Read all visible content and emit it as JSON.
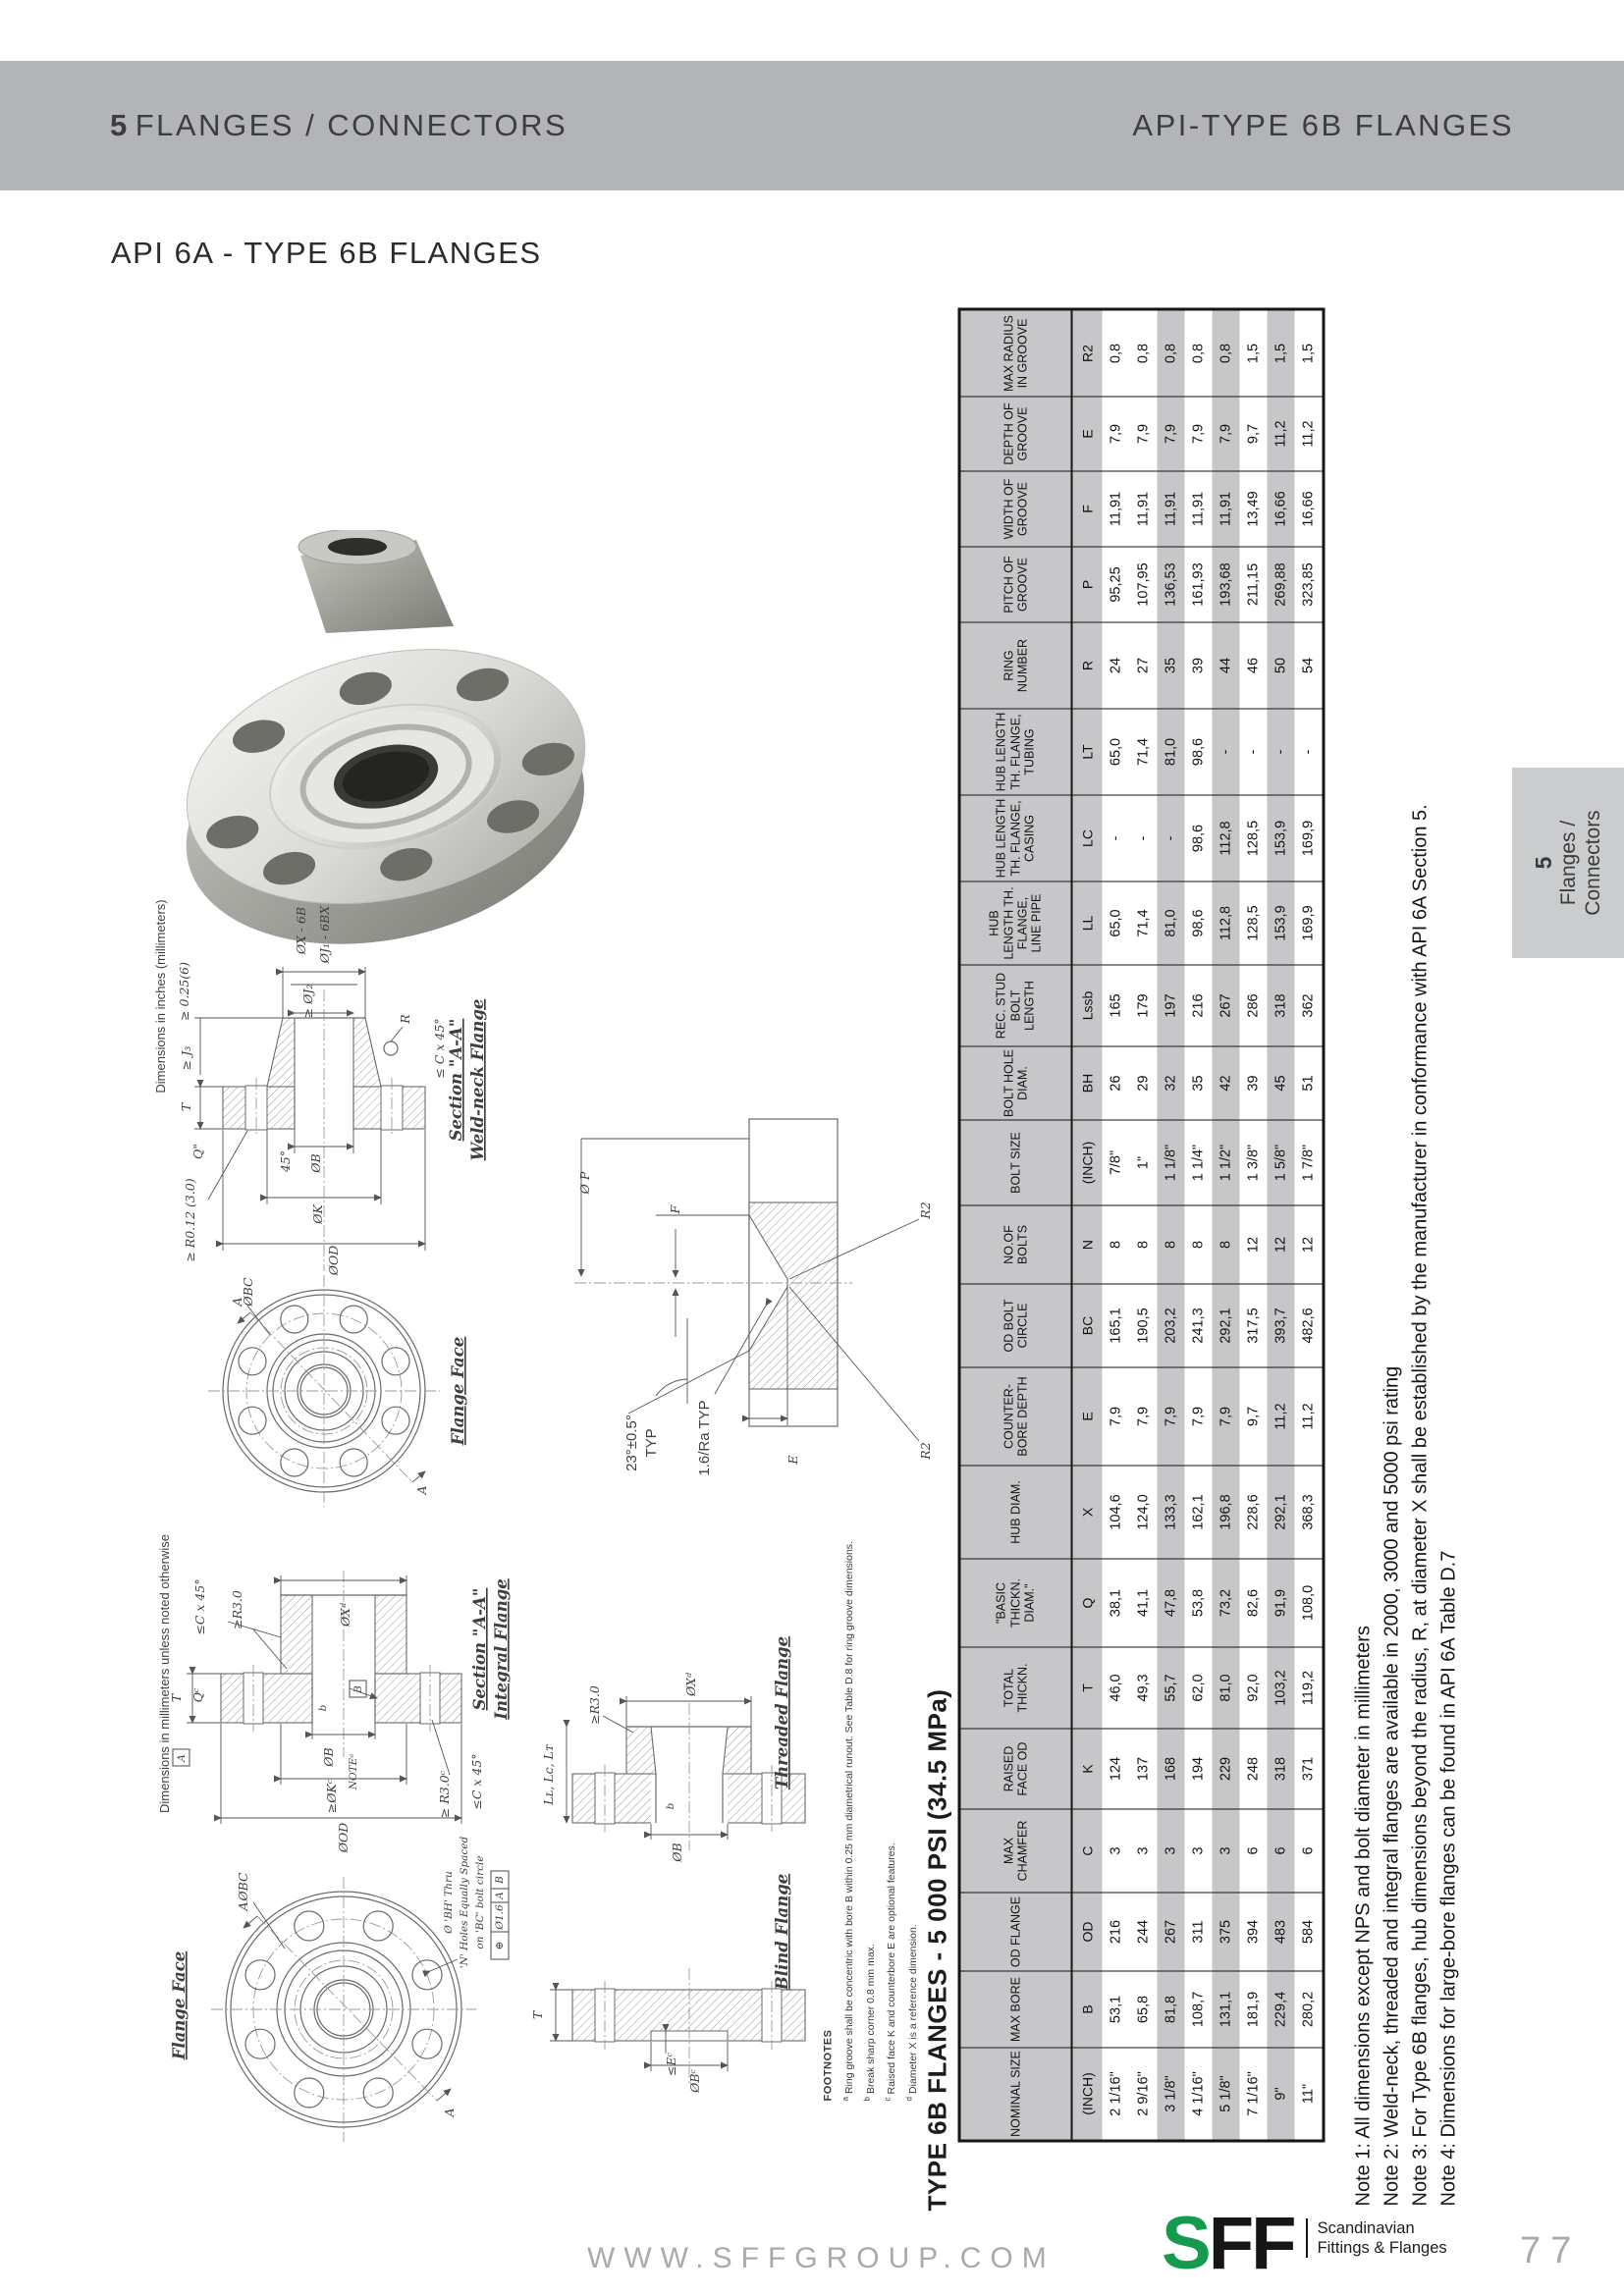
{
  "page": {
    "header": {
      "left_number": "5",
      "left_title": "FLANGES / CONNECTORS",
      "right_title": "API-TYPE 6B FLANGES"
    },
    "title": "API 6A - TYPE 6B FLANGES",
    "side_tab": {
      "number": "5",
      "line1": "Flanges /",
      "line2": "Connectors"
    },
    "footer": {
      "website": "WWW.SFFGROUP.COM",
      "logo_s": "S",
      "logo_ff": "FF",
      "logo_sub1": "Scandinavian",
      "logo_sub2": "Fittings & Flanges",
      "page_number": "77"
    },
    "colors": {
      "header_bar": "#b3b4b6",
      "table_gray": "#c7c7c9",
      "tab_gray": "#cbcccd",
      "logo_green": "#169a4f",
      "muted_gray": "#a7abae"
    }
  },
  "table": {
    "title": "TYPE 6B FLANGES - 5 000 PSI (34.5 MPa)",
    "columns": [
      {
        "label": "NOMINAL SIZE",
        "symbol": "(INCH)",
        "values": [
          "2 1/16\"",
          "2 9/16\"",
          "3 1/8\"",
          "4 1/16\"",
          "5 1/8\"",
          "7 1/16\"",
          "9\"",
          "11\""
        ]
      },
      {
        "label": "MAX BORE",
        "symbol": "B",
        "values": [
          "53,1",
          "65,8",
          "81,8",
          "108,7",
          "131,1",
          "181,9",
          "229,4",
          "280,2"
        ]
      },
      {
        "label": "OD FLANGE",
        "symbol": "OD",
        "values": [
          "216",
          "244",
          "267",
          "311",
          "375",
          "394",
          "483",
          "584"
        ]
      },
      {
        "label": "MAX CHAMFER",
        "symbol": "C",
        "values": [
          "3",
          "3",
          "3",
          "3",
          "3",
          "6",
          "6",
          "6"
        ]
      },
      {
        "label": "RAISED FACE OD",
        "symbol": "K",
        "values": [
          "124",
          "137",
          "168",
          "194",
          "229",
          "248",
          "318",
          "371"
        ]
      },
      {
        "label": "TOTAL THICKN.",
        "symbol": "T",
        "values": [
          "46,0",
          "49,3",
          "55,7",
          "62,0",
          "81,0",
          "92,0",
          "103,2",
          "119,2"
        ]
      },
      {
        "label": "\"BASIC THICKN. DIAM.\"",
        "symbol": "Q",
        "values": [
          "38,1",
          "41,1",
          "47,8",
          "53,8",
          "73,2",
          "82,6",
          "91,9",
          "108,0"
        ]
      },
      {
        "label": "HUB DIAM.",
        "symbol": "X",
        "values": [
          "104,6",
          "124,0",
          "133,3",
          "162,1",
          "196,8",
          "228,6",
          "292,1",
          "368,3"
        ]
      },
      {
        "label": "COUNTER- BORE DEPTH",
        "symbol": "E",
        "values": [
          "7,9",
          "7,9",
          "7,9",
          "7,9",
          "7,9",
          "9,7",
          "11,2",
          "11,2"
        ]
      },
      {
        "label": "OD BOLT CIRCLE",
        "symbol": "BC",
        "values": [
          "165,1",
          "190,5",
          "203,2",
          "241,3",
          "292,1",
          "317,5",
          "393,7",
          "482,6"
        ]
      },
      {
        "label": "NO.OF BOLTS",
        "symbol": "N",
        "values": [
          "8",
          "8",
          "8",
          "8",
          "8",
          "12",
          "12",
          "12"
        ]
      },
      {
        "label": "BOLT SIZE",
        "symbol": "(INCH)",
        "values": [
          "7/8\"",
          "1\"",
          "1 1/8\"",
          "1 1/4\"",
          "1 1/2\"",
          "1 3/8\"",
          "1 5/8\"",
          "1 7/8\""
        ]
      },
      {
        "label": "BOLT HOLE DIAM.",
        "symbol": "BH",
        "values": [
          "26",
          "29",
          "32",
          "35",
          "42",
          "39",
          "45",
          "51"
        ]
      },
      {
        "label": "REC. STUD BOLT LENGTH",
        "symbol": "Lssb",
        "values": [
          "165",
          "179",
          "197",
          "216",
          "267",
          "286",
          "318",
          "362"
        ]
      },
      {
        "label": "HUB LENGTH TH. FLANGE, LINE PIPE",
        "symbol": "LL",
        "values": [
          "65,0",
          "71,4",
          "81,0",
          "98,6",
          "112,8",
          "128,5",
          "153,9",
          "169,9"
        ]
      },
      {
        "label": "HUB LENGTH TH. FLANGE, CASING",
        "symbol": "LC",
        "values": [
          "-",
          "-",
          "-",
          "98,6",
          "112,8",
          "128,5",
          "153,9",
          "169,9"
        ]
      },
      {
        "label": "HUB LENGTH TH. FLANGE, TUBING",
        "symbol": "LT",
        "values": [
          "65,0",
          "71,4",
          "81,0",
          "98,6",
          "-",
          "-",
          "-",
          "-"
        ]
      },
      {
        "label": "RING NUMBER",
        "symbol": "R",
        "values": [
          "24",
          "27",
          "35",
          "39",
          "44",
          "46",
          "50",
          "54"
        ]
      },
      {
        "label": "PITCH OF GROOVE",
        "symbol": "P",
        "values": [
          "95,25",
          "107,95",
          "136,53",
          "161,93",
          "193,68",
          "211,15",
          "269,88",
          "323,85"
        ]
      },
      {
        "label": "WIDTH OF GROOVE",
        "symbol": "F",
        "values": [
          "11,91",
          "11,91",
          "11,91",
          "11,91",
          "11,91",
          "13,49",
          "16,66",
          "16,66"
        ]
      },
      {
        "label": "DEPTH OF GROOVE",
        "symbol": "E",
        "values": [
          "7,9",
          "7,9",
          "7,9",
          "7,9",
          "7,9",
          "9,7",
          "11,2",
          "11,2"
        ]
      },
      {
        "label": "MAX RADIUS IN GROOVE",
        "symbol": "R2",
        "values": [
          "0,8",
          "0,8",
          "0,8",
          "0,8",
          "0,8",
          "1,5",
          "1,5",
          "1,5"
        ]
      }
    ],
    "shaded_rows": [
      2,
      4,
      6
    ]
  },
  "notes": [
    "Note 1: All dimensions except NPS and bolt diameter in millimeters",
    "Note 2: Weld-neck, threaded and integral flanges are available in 2000, 3000 and 5000 psi rating",
    "Note 3: For Type 6B flanges, hub dimensions beyond the radius, R, at diameter X shall be established by the manufacturer in conformance with API 6A Section 5.",
    "Note 4: Dimensions for large-bore flanges can be found in API 6A Table D.7"
  ],
  "footnotes": {
    "heading": "FOOTNOTES",
    "items": [
      {
        "marker": "a",
        "text": "Ring groove shall be concentric with bore B within 0.25 mm diametrical runout. See Table D.8 for ring groove dimensions."
      },
      {
        "marker": "b",
        "text": "Break sharp corner 0.8 mm max."
      },
      {
        "marker": "c",
        "text": "Raised face K and counterbore E are optional features."
      },
      {
        "marker": "d",
        "text": "Diameter X is a reference dimension."
      }
    ]
  },
  "drawings": {
    "dims_note_inches": "Dimensions in inches (millimeters)",
    "dims_note_mm": "Dimensions in millimeters unless noted otherwise",
    "weldneck": {
      "cap1": "Section \"A-A\"",
      "cap2": "Weld-neck Flange",
      "dim_x": "ØX - 6B",
      "dim_j1": "ØJ₁ - 6BX",
      "dim_j2": "≥ ØJ₂",
      "dim_025": "≥ 0.25(6)",
      "dim_j3": "≥ J₃",
      "dim_t": "T",
      "dim_q": "Q\"",
      "dim_r": "R",
      "dim_c45": "≤ C x 45°",
      "dim_45": "45°",
      "dim_b": "ØB",
      "dim_k": "ØK",
      "dim_od": "ØOD",
      "dim_r012": "≥ R0.12 (3.0)"
    },
    "flange_face_top": {
      "caption": "Flange Face",
      "dim_bc": "ØBC",
      "letter": "A"
    },
    "groove": {
      "dim_p": "Ø P",
      "dim_f": "F",
      "angle": "23°±0.5°",
      "typ": "TYP",
      "ra": "1.6/Ra  TYP",
      "dim_e": "E",
      "dim_r2": "R2"
    },
    "integral": {
      "cap1": "Section \"A-A\"",
      "cap2": "Integral Flange",
      "dim_c45": "≤C x 45°",
      "dim_r3": "≥R3.0",
      "dim_x": "ØXᵈ",
      "dim_t": "T",
      "dim_q": "Qᶜ",
      "datum_a": "A",
      "datum_b": "B",
      "leader_b": "b",
      "dim_bb": "ØB",
      "note_a": "NOTEᵃ",
      "dim_k": "≥ØKᶜ",
      "dim_od": "ØOD",
      "dim_r3c": "≥ R3.0ᶜ",
      "dim_c45b": "≤C x 45°"
    },
    "threaded": {
      "caption": "Threaded Flange",
      "dim_r3": "≥R3.0",
      "dim_x": "ØXᵈ",
      "leader_b": "b",
      "dim_bb": "ØB",
      "dim_l": "Lʟ, Lᴄ, Lᴛ"
    },
    "blind": {
      "caption": "Blind Flange",
      "dim_e": "≤Eᶜ",
      "dim_b": "ØBᶜ",
      "dim_t": "T"
    },
    "flange_face_bottom": {
      "caption": "Flange Face",
      "dim_bc": "ØBC",
      "letter": "A",
      "callout1": "Ø 'BH' Thru",
      "callout2": "'N' Holes Equally Spaced",
      "callout3": "on 'BC' bolt circle",
      "fcf_sym": "⊕",
      "fcf_tol": "Ø1.6",
      "fcf_a": "A",
      "fcf_b": "B"
    }
  }
}
